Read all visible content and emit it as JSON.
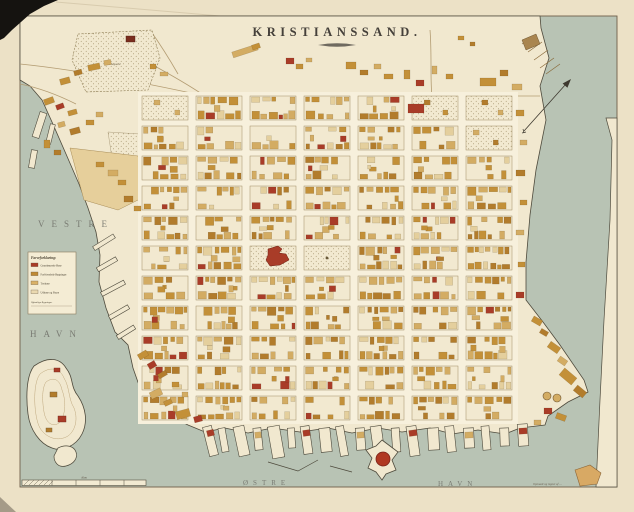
{
  "title": "KRISTIANSSAND.",
  "labels": {
    "west_harbor_line1": "VESTRE",
    "west_harbor_line2": "HAVN",
    "east_harbor_line1": "ØSTRE",
    "east_harbor_line2": "HAVN",
    "cemetery": "Kirkegaard",
    "scale": "Alen",
    "credit": "Opmaalt og tegnet af …"
  },
  "legend": {
    "title": "Farveforklaring:",
    "items": [
      {
        "label": "Grundmurede Huse",
        "color": "#a93c28"
      },
      {
        "label": "Forblændede Bygninger",
        "color": "#bf8a35"
      },
      {
        "label": "Træhuse",
        "color": "#d9b168"
      },
      {
        "label": "Udhuse og Skure",
        "color": "#ead9b0"
      }
    ],
    "footnote": "Offentlige Bygninger"
  },
  "colors": {
    "paper": "#ece1c6",
    "land": "#f1e8cf",
    "water": "#b8c3b4",
    "street": "#f7f0dc",
    "block": "#f2e9d0",
    "shoreline": "#4e4a3c",
    "block_line": "#a08c64",
    "red_building": "#a93c28",
    "ochre_building": "#c39038",
    "tan_building": "#d3ac63",
    "dark_ochre_building": "#b27c2c",
    "pale_building": "#e4cf9d",
    "contour": "#bfa87e",
    "road": "#b39c72",
    "ink": "#3f3a30"
  }
}
